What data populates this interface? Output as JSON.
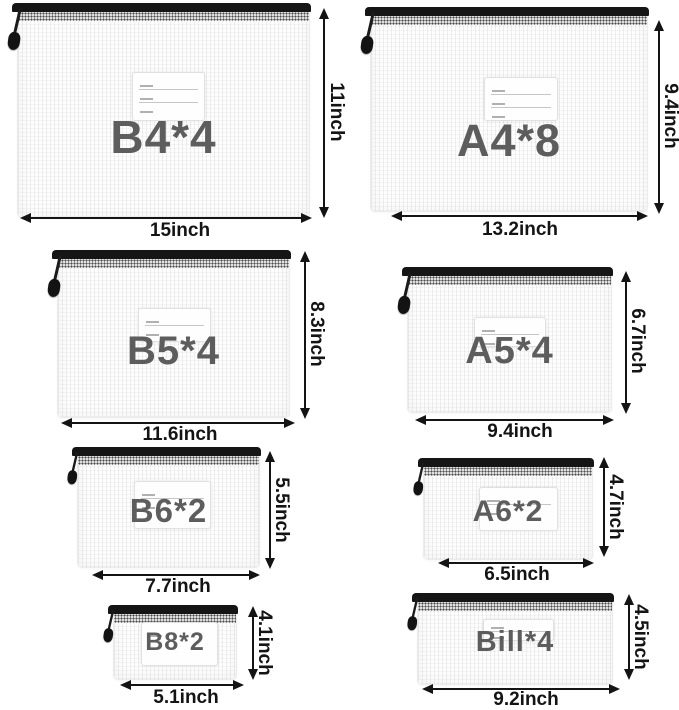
{
  "colors": {
    "size_text": "#5d5d5d",
    "dimension_text": "#141414",
    "zipper": "#151515",
    "background": "#ffffff"
  },
  "bags": [
    {
      "name": "B4*4",
      "width": "15inch",
      "height": "11inch"
    },
    {
      "name": "A4*8",
      "width": "13.2inch",
      "height": "9.4inch"
    },
    {
      "name": "B5*4",
      "width": "11.6inch",
      "height": "8.3inch"
    },
    {
      "name": "A5*4",
      "width": "9.4inch",
      "height": "6.7inch"
    },
    {
      "name": "B6*2",
      "width": "7.7inch",
      "height": "5.5inch"
    },
    {
      "name": "A6*2",
      "width": "6.5inch",
      "height": "4.7inch"
    },
    {
      "name": "B8*2",
      "width": "5.1inch",
      "height": "4.1inch"
    },
    {
      "name": "Bill*4",
      "width": "9.2inch",
      "height": "4.5inch"
    }
  ]
}
